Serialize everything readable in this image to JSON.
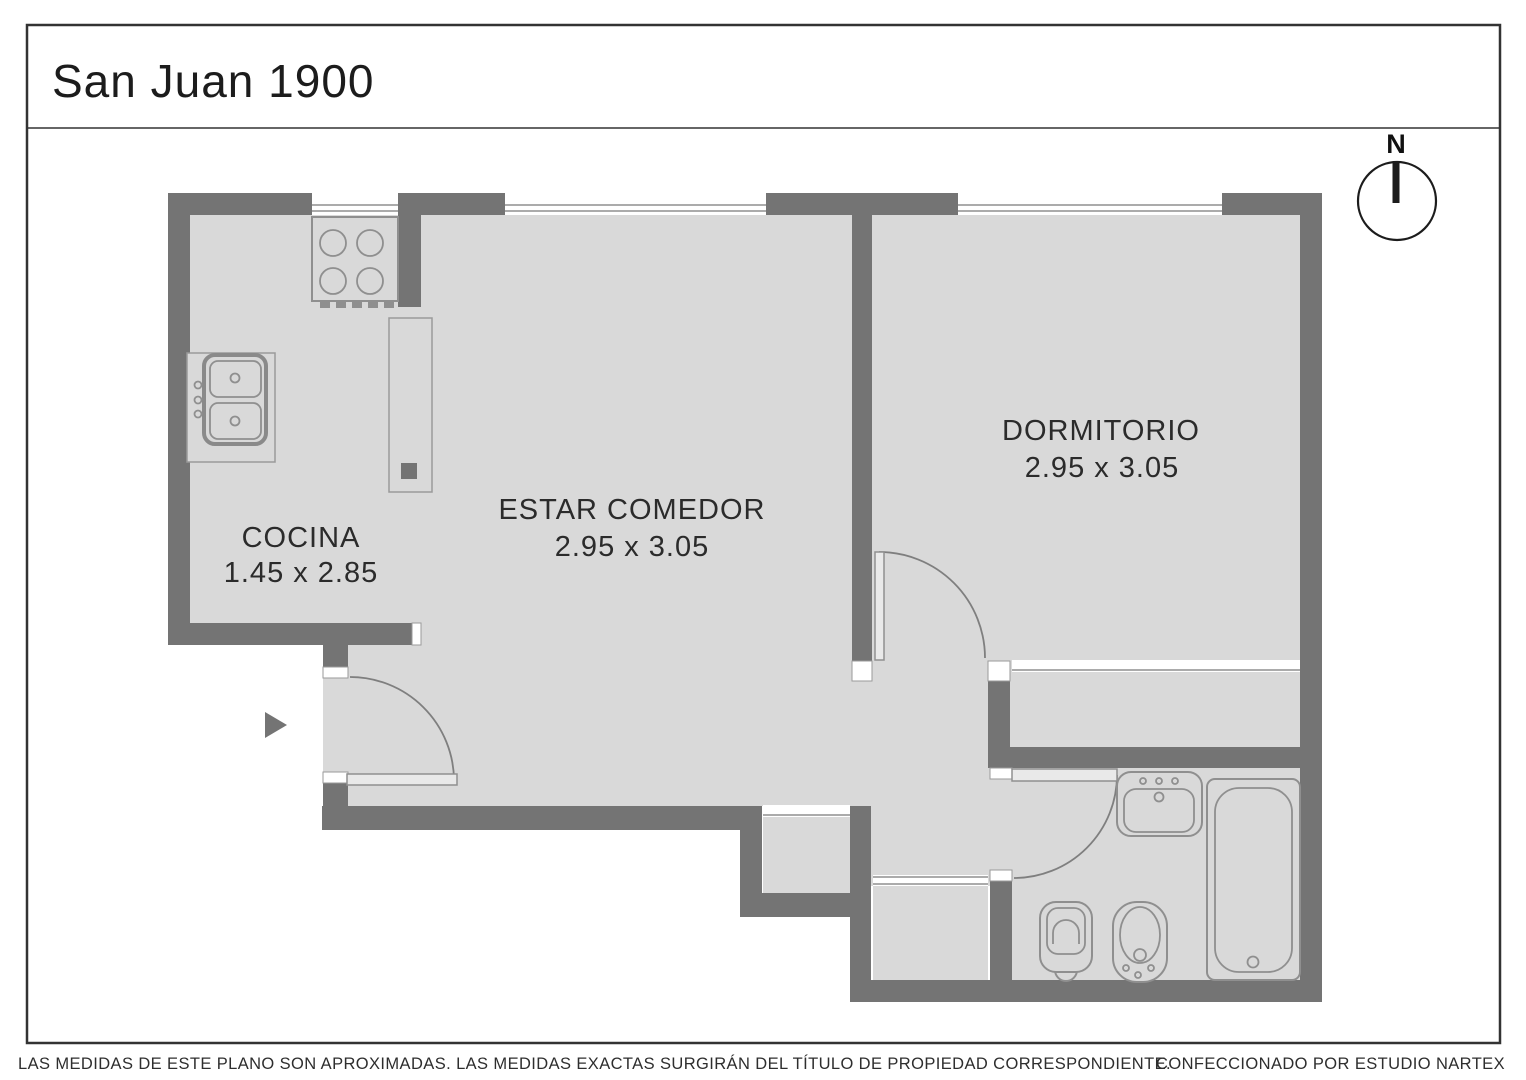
{
  "title": "San Juan 1900",
  "compass": {
    "label": "N"
  },
  "rooms": [
    {
      "name": "COCINA",
      "dimensions": "1.45 x 2.85"
    },
    {
      "name": "ESTAR COMEDOR",
      "dimensions": "2.95 x 3.05"
    },
    {
      "name": "DORMITORIO",
      "dimensions": "2.95 x 3.05"
    }
  ],
  "fixtures": [
    "stove-icon",
    "kitchen-sink-icon",
    "kitchen-cabinet-icon",
    "bath-sink-icon",
    "bathtub-icon",
    "toilet-icon",
    "bidet-icon",
    "entry-arrow-icon",
    "compass-icon"
  ],
  "footer": {
    "disclaimer": "LAS MEDIDAS  DE ESTE PLANO SON APROXIMADAS. LAS MEDIDAS EXACTAS SURGIRÁN DEL TÍTULO DE PROPIEDAD CORRESPONDIENTE.",
    "credit": "CONFECCIONADO POR ESTUDIO NARTEX"
  },
  "colors": {
    "wall": "#747474",
    "floor": "#d9d9d9",
    "fixture_outline": "#8f8f8f",
    "text": "#2b2b2b",
    "background": "#ffffff"
  }
}
